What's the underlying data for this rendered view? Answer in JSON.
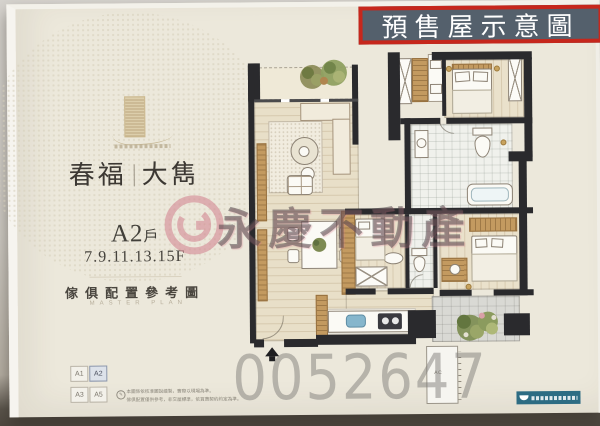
{
  "stamp": {
    "label": "預售屋示意圖"
  },
  "brand": {
    "title_left": "春福",
    "title_right": "大雋"
  },
  "unit": {
    "name_main": "A2",
    "name_suffix": "戶",
    "floors": "7.9.11.13.15F",
    "caption": "傢俱配置參考圖",
    "caption_en": "MASTER PLAN"
  },
  "unit_grid": {
    "cells": [
      "A1",
      "A2",
      "A3",
      "A5"
    ],
    "selected": "A2"
  },
  "watermark": {
    "brand_text": "永慶不動產",
    "serial": "0052647"
  },
  "plan": {
    "ac_label": "AC"
  },
  "disclaimer": {
    "line1": "本圖係依核准圖說繪製，實際以現場為準。",
    "line2": "傢俱配置僅供參考，非交屋標準，依買賣契約約定為準。"
  },
  "colors": {
    "stamp_red": "#c6271c",
    "stamp_bg": "#54606c",
    "watermark_pink": "#d2808d"
  }
}
